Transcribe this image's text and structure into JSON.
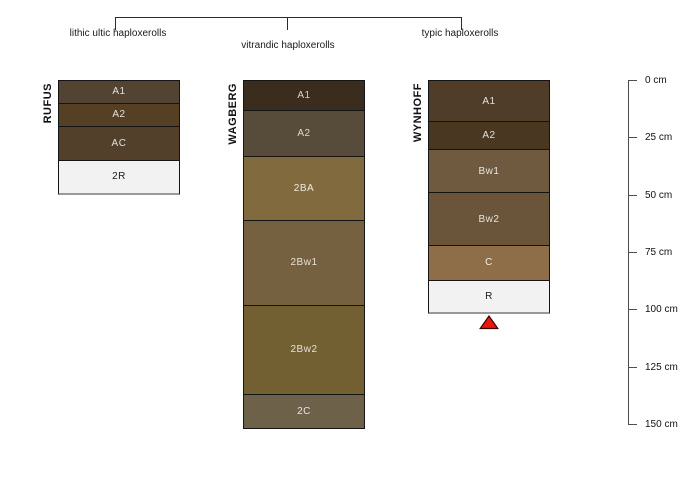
{
  "taxonomy": {
    "groups": [
      {
        "label": "lithic ultic haploxerolls"
      },
      {
        "label": "vitrandic haploxerolls"
      },
      {
        "label": "typic haploxerolls"
      }
    ]
  },
  "depth_axis": {
    "unit": "cm",
    "tick_values": [
      0,
      25,
      50,
      75,
      100,
      125,
      150
    ],
    "ticks": [
      "0 cm",
      "25 cm",
      "50 cm",
      "75 cm",
      "100 cm",
      "125 cm",
      "150 cm"
    ],
    "range": [
      0,
      150
    ]
  },
  "chart_data": {
    "type": "soil-profile-sketch",
    "depth_unit": "cm",
    "axis_range": [
      0,
      150
    ],
    "profiles": [
      {
        "name": "RUFUS",
        "taxon": "lithic ultic haploxerolls",
        "horizons": [
          {
            "label": "A1",
            "top": 0,
            "bottom": 10,
            "color": "#534333",
            "text_color": "#e4e0d9",
            "light": false
          },
          {
            "label": "A2",
            "top": 10,
            "bottom": 20,
            "color": "#554026",
            "text_color": "#e4e0d9",
            "light": false
          },
          {
            "label": "AC",
            "top": 20,
            "bottom": 35,
            "color": "#53402a",
            "text_color": "#e4e0d9",
            "light": false
          },
          {
            "label": "2R",
            "top": 35,
            "bottom": 50,
            "color": "#f2f2f2",
            "text_color": "#1a1a1a",
            "light": true
          }
        ]
      },
      {
        "name": "WAGBERG",
        "taxon": "vitrandic haploxerolls",
        "horizons": [
          {
            "label": "A1",
            "top": 0,
            "bottom": 13,
            "color": "#3a2d1e",
            "text_color": "#d8d3cb",
            "light": false
          },
          {
            "label": "A2",
            "top": 13,
            "bottom": 33,
            "color": "#564c39",
            "text_color": "#dedad2",
            "light": false
          },
          {
            "label": "2BA",
            "top": 33,
            "bottom": 61,
            "color": "#816a3d",
            "text_color": "#efe9de",
            "light": false
          },
          {
            "label": "2Bw1",
            "top": 61,
            "bottom": 98,
            "color": "#75603f",
            "text_color": "#e6e1d8",
            "light": false
          },
          {
            "label": "2Bw2",
            "top": 98,
            "bottom": 137,
            "color": "#726033",
            "text_color": "#e6e1d8",
            "light": false
          },
          {
            "label": "2C",
            "top": 137,
            "bottom": 152,
            "color": "#6e614a",
            "text_color": "#e9e5de",
            "light": false
          }
        ]
      },
      {
        "name": "WYNHOFF",
        "taxon": "typic haploxerolls",
        "horizons": [
          {
            "label": "A1",
            "top": 0,
            "bottom": 18,
            "color": "#4f3d29",
            "text_color": "#e4e0d9",
            "light": false
          },
          {
            "label": "A2",
            "top": 18,
            "bottom": 30,
            "color": "#493722",
            "text_color": "#e4e0d9",
            "light": false
          },
          {
            "label": "Bw1",
            "top": 30,
            "bottom": 49,
            "color": "#6f5a40",
            "text_color": "#e9e4dc",
            "light": false
          },
          {
            "label": "Bw2",
            "top": 49,
            "bottom": 72,
            "color": "#6a543a",
            "text_color": "#e9e4dc",
            "light": false
          },
          {
            "label": "C",
            "top": 72,
            "bottom": 87,
            "color": "#8d6e48",
            "text_color": "#f1ece4",
            "light": false
          },
          {
            "label": "R",
            "top": 87,
            "bottom": 102,
            "color": "#f2f2f2",
            "text_color": "#1a1a1a",
            "light": true
          }
        ]
      }
    ],
    "marker": {
      "profile": "WYNHOFF",
      "shape": "triangle-up",
      "fill_color": "#ee1409",
      "stroke_color": "#3a0400",
      "position_cm": 102
    }
  }
}
